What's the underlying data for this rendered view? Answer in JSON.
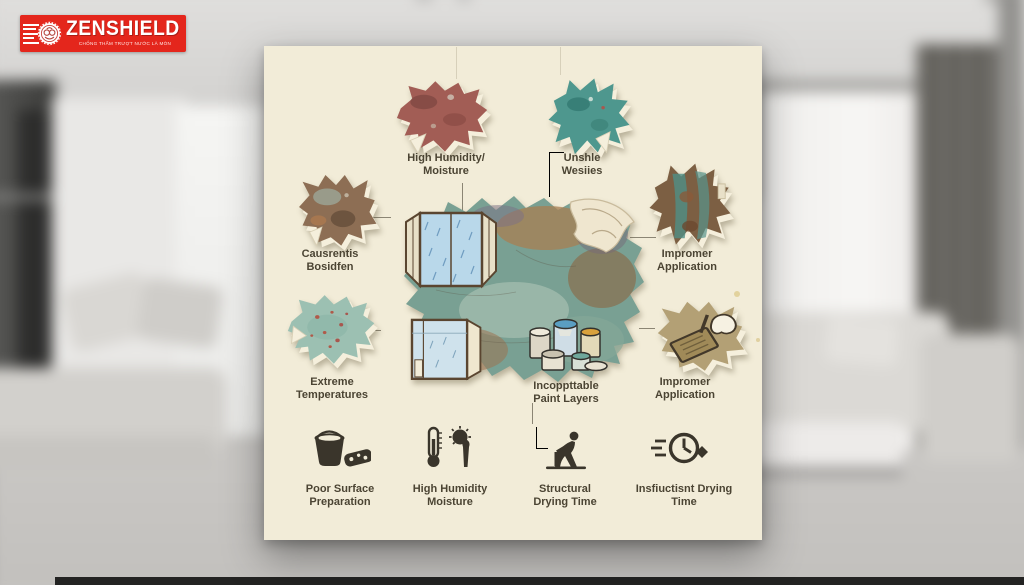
{
  "logo": {
    "brand": "ZENSHIELD",
    "tagline": "CHỐNG THẤM TRƯỢT NƯỚC LÀ MÒN",
    "background_color": "#e4261c",
    "text_color": "#ffffff",
    "emblem_icon": "rosette-seal-icon",
    "speed_lines_icon": "speed-lines-icon"
  },
  "infographic": {
    "card_color": "#f2ecd8",
    "label_color": "#4b4433",
    "callouts": [
      {
        "position": "top-left",
        "label": "High Humidity/\nMoisture",
        "patch_icon": "peeled-paint-patch-red",
        "patch_color": "#a25d55"
      },
      {
        "position": "top-right",
        "label": "Unshle\nWesiies",
        "patch_icon": "peeled-paint-patch-teal",
        "patch_color": "#4e978e"
      },
      {
        "position": "mid-left",
        "label": "Causrentis\nBosidfen",
        "patch_icon": "peeled-paint-patch-rust",
        "patch_color": "#8d6e54"
      },
      {
        "position": "mid-right",
        "label": "Impromer\nApplication",
        "patch_icon": "peeled-paint-patch-rust-teal",
        "patch_color": "#7c5f43"
      },
      {
        "position": "lower-left",
        "label": "Extreme\nTemperatures",
        "patch_icon": "peeled-paint-patch-speckled",
        "patch_color": "#9cc0b2"
      },
      {
        "position": "center-bottom",
        "label": "Incoppttable\nPaint Layers",
        "patch_icon": "paint-cans-illustration"
      },
      {
        "position": "lower-right",
        "label": "Impromer\nApplication",
        "patch_icon": "trowel-hand-patch",
        "patch_color": "#b3a075"
      }
    ],
    "center_art": {
      "icons": [
        "central-peeled-wall-illustration",
        "open-window-rain-illustration",
        "open-window-interior-illustration",
        "paint-cans-illustration",
        "paint-curl-illustration"
      ],
      "base_color": "#79a093"
    },
    "bottom_row": [
      {
        "icon": "bucket-sponge-icon",
        "label": "Poor Surface\nPreparation"
      },
      {
        "icon": "thermometer-sun-icon",
        "label": "High Humidity\nMoisture"
      },
      {
        "icon": "worker-drilling-icon",
        "label": "Structural\nDrying Time"
      },
      {
        "icon": "speeding-clock-icon",
        "label": "Insfiuctisnt Drying\nTime"
      }
    ]
  }
}
